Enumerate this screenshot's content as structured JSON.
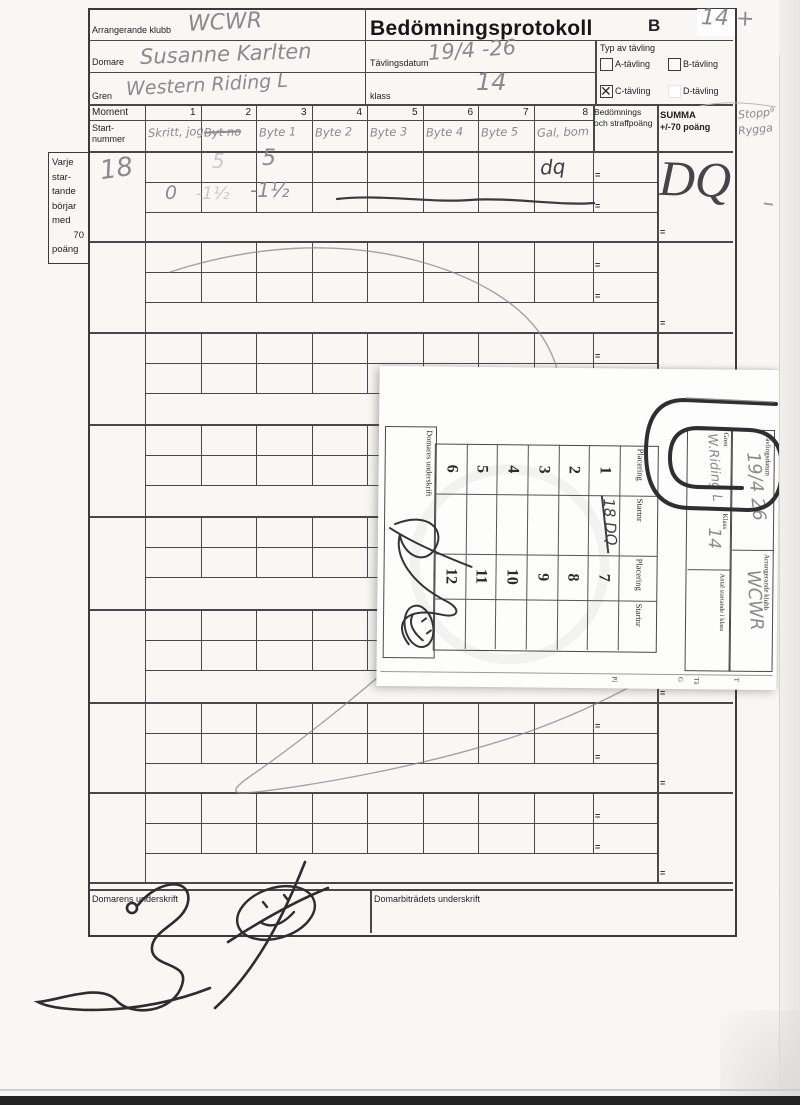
{
  "form": {
    "title": "Bedömningsprotokoll",
    "series_letter": "B",
    "corner_number": "14 +",
    "margin_note": [
      "Stopp⁹",
      "Rygga"
    ],
    "club": {
      "label": "Arrangerande klubb",
      "value": "WCWR"
    },
    "judge": {
      "label": "Domare",
      "value": "Susanne Karlten"
    },
    "discipline": {
      "label": "Gren",
      "value": "Western Riding L"
    },
    "date": {
      "label": "Tävlingsdatum",
      "value": "19/4 -26"
    },
    "klass": {
      "label": "klass",
      "value": "14"
    },
    "competition_type": {
      "label": "Typ av tävling",
      "options": [
        {
          "label": "A-tävling",
          "checked": false
        },
        {
          "label": "B-tävling",
          "checked": false
        },
        {
          "label": "C-tävling",
          "checked": true
        },
        {
          "label": "D-tävling",
          "checked": false
        }
      ]
    },
    "moment": {
      "label": "Moment",
      "numbers": [
        "1",
        "2",
        "3",
        "4",
        "5",
        "6",
        "7",
        "8"
      ]
    },
    "start_col_label": "Start-nummer",
    "handwritten_moments": [
      {
        "text": "Skritt, jog",
        "struck": false
      },
      {
        "text": "Byt no",
        "struck": true
      },
      {
        "text": "Byte 1",
        "struck": false
      },
      {
        "text": "Byte 2",
        "struck": false
      },
      {
        "text": "Byte 3",
        "struck": false
      },
      {
        "text": "Byte 4",
        "struck": false
      },
      {
        "text": "Byte 5",
        "struck": false
      },
      {
        "text": "Gal, bom",
        "struck": false
      }
    ],
    "score_header": {
      "bedomning": "Bedömnings och straffpoäng",
      "summa_line1": "SUMMA",
      "summa_line2": "+/-70 poäng"
    },
    "equals_sign": "=",
    "sidebar_lines": [
      "Varje",
      "star-",
      "tande",
      "börjar",
      "med",
      "70",
      "poäng"
    ],
    "blocks_count": 8,
    "entry": {
      "start_number": "18",
      "row1_c2_faint": "5",
      "row1_c3": "5",
      "row1_c8": "dq",
      "row2_c1": "0",
      "row2_c2_faint": "-1½",
      "row2_c3": "-1½",
      "summa": "DQ"
    },
    "footer": {
      "judge_signature_label": "Domarens underskrift",
      "assistant_signature_label": "Domarbiträdets underskrift"
    }
  },
  "slip": {
    "date": {
      "label": "Tävlingsdatum",
      "value": "19/4 26"
    },
    "club": {
      "label": "Arrangerande klubb",
      "value": "WCWR"
    },
    "discipline": {
      "label": "Gren",
      "value": "W.Riding L"
    },
    "klass": {
      "label": "Klass",
      "value": "14"
    },
    "starters": {
      "label": "Antal startande i klass",
      "value": ""
    },
    "table": {
      "headers": [
        "Placering",
        "Startnr",
        "Placering",
        "Startnr"
      ],
      "placings_left": [
        "1",
        "2",
        "3",
        "4",
        "5",
        "6"
      ],
      "placings_right": [
        "7",
        "8",
        "9",
        "10",
        "11",
        "12"
      ],
      "startnr_row1": "18 DQ"
    },
    "signature_label": "Domares underskrift",
    "edge_fragments": [
      "T",
      "Tä",
      "G",
      "Pl"
    ]
  }
}
